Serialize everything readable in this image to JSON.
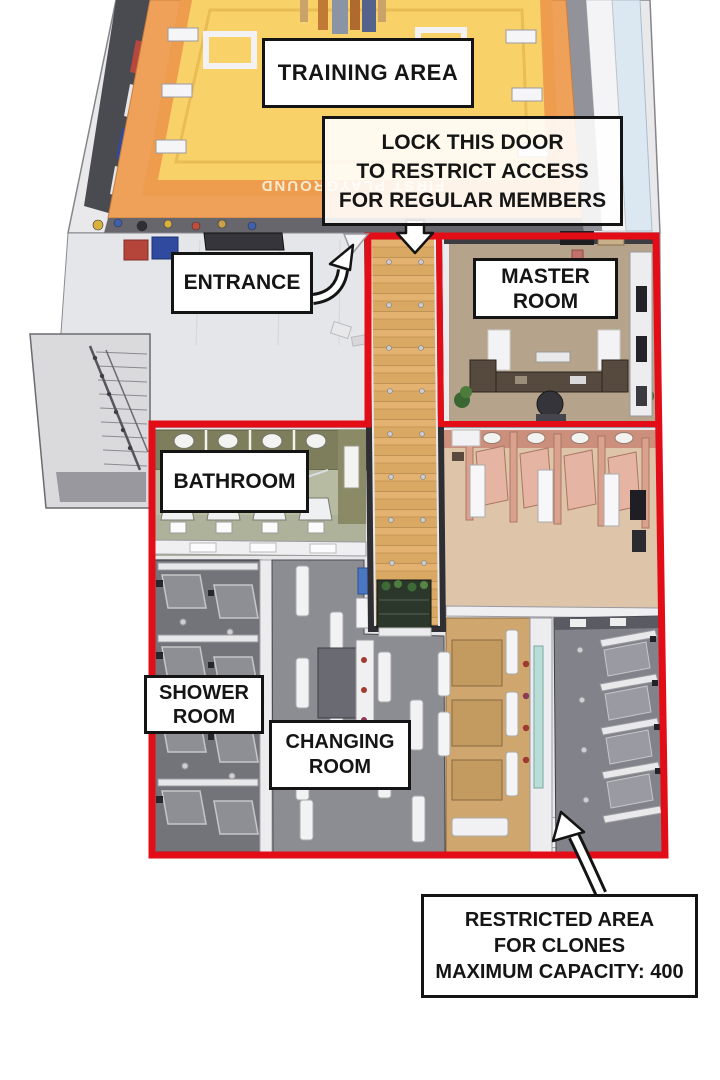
{
  "scene": {
    "type": "isometric-floorplan",
    "floor_markings": {
      "training_mat_text": "FIRST PLAYGROUND"
    }
  },
  "labels": {
    "training_area": "TRAINING AREA",
    "lock_door_note": "LOCK THIS DOOR\nTO RESTRICT ACCESS\nFOR REGULAR MEMBERS",
    "entrance": "ENTRANCE",
    "master_room": "MASTER\nROOM",
    "bathroom": "BATHROOM",
    "shower_room": "SHOWER\nROOM",
    "changing_room": "CHANGING\nROOM",
    "restricted_note": "RESTRICTED AREA\nFOR CLONES\nMAXIMUM CAPACITY: 400"
  },
  "colors": {
    "restricted_red": "#e20d17",
    "label_border": "#141414",
    "label_bg": "#ffffff",
    "mat_yellow": "#f9d169",
    "mat_orange": "#ee9c4e",
    "corridor_wood": "#d9a963"
  }
}
